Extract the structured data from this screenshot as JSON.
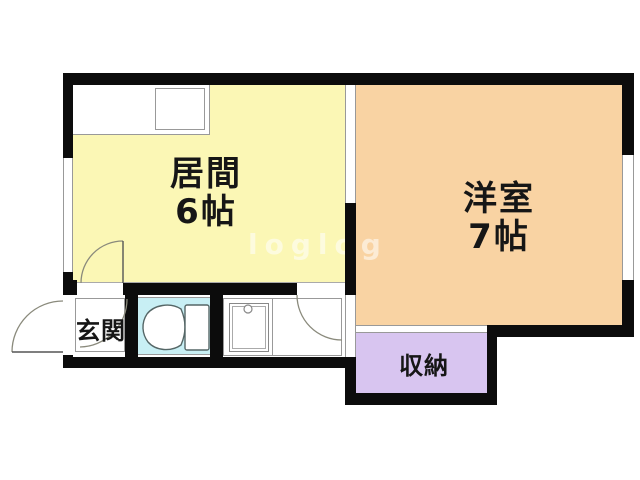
{
  "watermark": "loglog",
  "rooms": {
    "living": {
      "name": "居間",
      "size": "6帖"
    },
    "western": {
      "name": "洋室",
      "size": "7帖"
    },
    "entrance": {
      "name": "玄関"
    },
    "storage": {
      "name": "収納"
    }
  },
  "colors": {
    "living": "#fbf7b5",
    "western": "#f9d3a3",
    "storage": "#d8c5f0",
    "toilet": "#c8eff4",
    "wall": "#0c0c0c",
    "line": "#999999"
  },
  "icons": {
    "toilet": "toilet-icon",
    "sink": "kitchen-sink-icon",
    "stove": "stove-icon"
  }
}
